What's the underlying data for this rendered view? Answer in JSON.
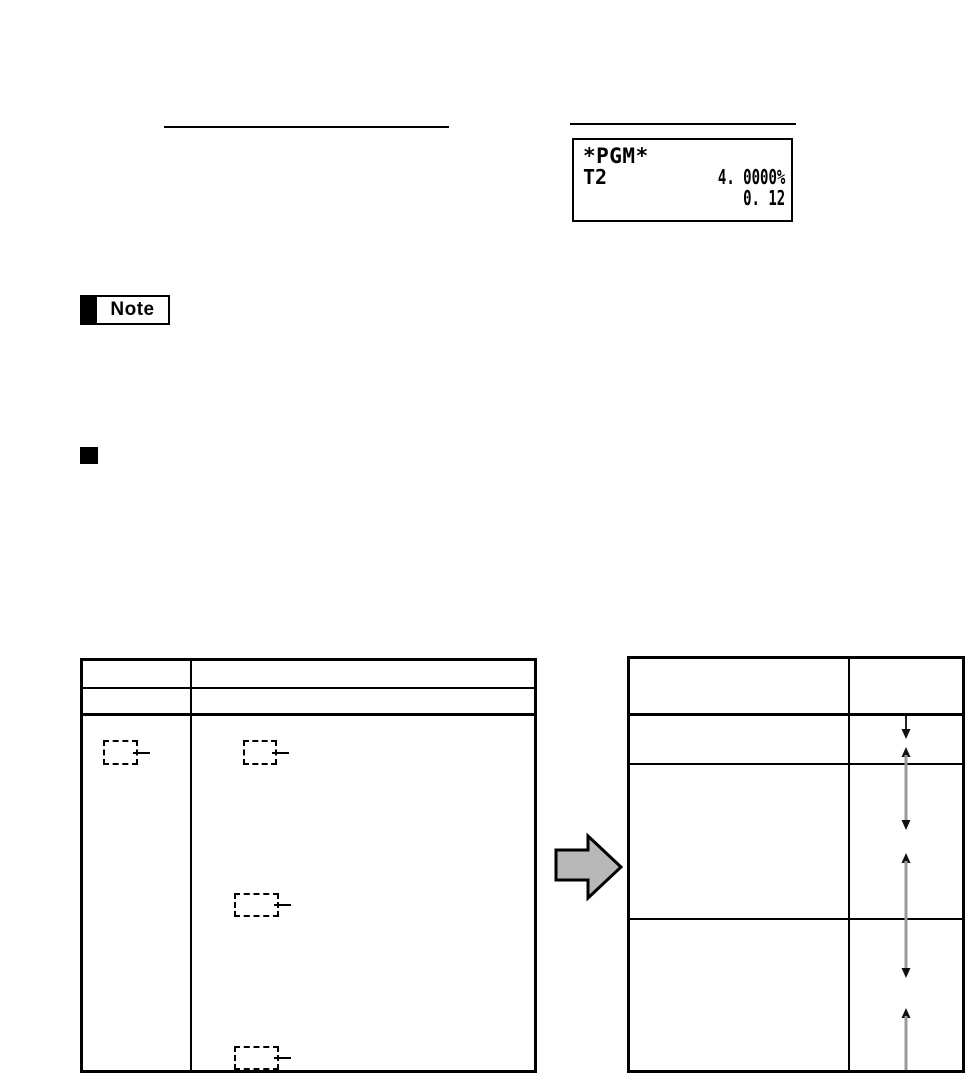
{
  "colors": {
    "ink": "#000000",
    "transform_arrow_fill": "#b8b8b8",
    "connector_line_gray": "#9a9a9a"
  },
  "receipt_display": {
    "mode": "*PGM*",
    "tax_label": "T2",
    "tax_rate": "4. 0000%",
    "tax_amount": "0. 12"
  },
  "note_callout": {
    "label": "Note"
  },
  "section_heading": {
    "bullet_shape": "filled-black-square"
  },
  "left_table": {
    "header_rows": 2,
    "columns": 2,
    "header_cells": [
      "",
      "",
      "",
      ""
    ],
    "keys": [
      {
        "icon": "blank-key-icon",
        "column": "left"
      },
      {
        "icon": "blank-key-icon",
        "column": "right"
      },
      {
        "icon": "blank-key-icon",
        "column": "right"
      },
      {
        "icon": "blank-key-icon",
        "column": "right"
      }
    ]
  },
  "right_table": {
    "header_rows": 1,
    "columns": 2,
    "body_rows": 3,
    "connector_arrows": [
      "down-arrow",
      "up-down-arrow",
      "up-down-arrow",
      "up-arrow"
    ]
  },
  "transform_arrow": {
    "icon": "right-block-arrow",
    "direction": "right"
  }
}
